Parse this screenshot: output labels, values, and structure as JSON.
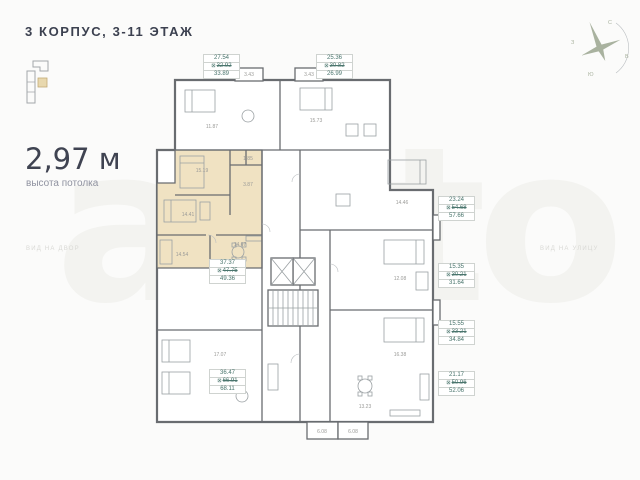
{
  "header": {
    "title": "3 КОРПУС, 3-11 ЭТАЖ"
  },
  "ceiling": {
    "value": "2,97 м",
    "label": "высота потолка"
  },
  "views": {
    "left": "ВИД НА ДВОР",
    "right": "ВИД НА УЛИЦУ"
  },
  "watermark": {
    "text": "avito"
  },
  "compass": {
    "n": "С",
    "e": "В",
    "s": "Ю",
    "w": "З"
  },
  "colors": {
    "highlight_beige": "#f0e2c2",
    "label_text": "#4a756d",
    "wall_gray": "#696c70",
    "background": "#fbfbfa"
  },
  "area_labels": [
    {
      "id": "top-left",
      "living": "27.54",
      "total": "32.92",
      "total_with_balcony": "33.89",
      "selected": false
    },
    {
      "id": "top-right",
      "living": "25.36",
      "total": "30.82",
      "total_with_balcony": "26.99",
      "selected": false
    },
    {
      "id": "right-1",
      "living": "23.24",
      "total": "54.68",
      "total_with_balcony": "57.66",
      "selected": false
    },
    {
      "id": "right-2",
      "living": "15.35",
      "total": "30.21",
      "total_with_balcony": "31.64",
      "selected": false
    },
    {
      "id": "right-3",
      "living": "15.55",
      "total": "33.21",
      "total_with_balcony": "34.84",
      "selected": false
    },
    {
      "id": "right-4",
      "living": "21.17",
      "total": "50.96",
      "total_with_balcony": "52.06",
      "selected": false
    },
    {
      "id": "selected-apartment",
      "living": "37.37",
      "total": "47.75",
      "total_with_balcony": "49.36",
      "selected": true
    },
    {
      "id": "bottom-left",
      "living": "36.47",
      "total": "66.91",
      "total_with_balcony": "68.11",
      "selected": false
    }
  ],
  "rooms": [
    "15.19",
    "14.41",
    "14.54",
    "14.67",
    "3.87",
    "1.85",
    "11.87",
    "15.73",
    "14.46",
    "12.08",
    "16.38",
    "13.23",
    "17.07",
    "10.10"
  ],
  "balconies": [
    "3.43",
    "3.43",
    "6.08",
    "6.08"
  ]
}
